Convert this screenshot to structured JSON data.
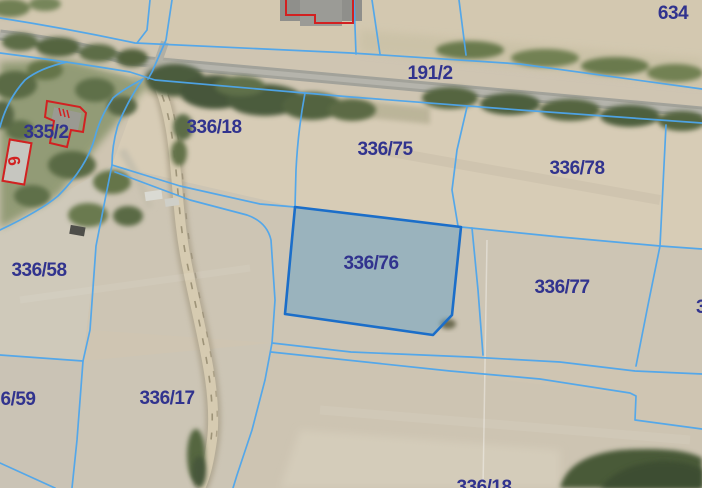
{
  "map": {
    "type": "cadastral-parcel-map-over-aerial-imagery",
    "highlighted_parcel": "336/76",
    "visible_parcel_labels": [
      "335/2",
      "9",
      "336/18",
      "191/2",
      "634",
      "336/75",
      "336/78",
      "336/58",
      "336/76",
      "336/77",
      "6/59",
      "336/17",
      "336/18",
      "3"
    ]
  },
  "labels": {
    "p335_2": "335/2",
    "house_9": "9",
    "p336_18": "336/18",
    "p191_2": "191/2",
    "p634": "634",
    "p336_75": "336/75",
    "p336_78": "336/78",
    "p336_58": "336/58",
    "p336_76": "336/76",
    "p336_77": "336/77",
    "p336_59_clipped": "6/59",
    "p336_17": "336/17",
    "p336_18_bottom": "336/18",
    "p_right_clipped": "3"
  },
  "colors": {
    "boundary": "#4ea6ec",
    "highlight_stroke": "#1b6ec9",
    "highlight_fill": "rgba(104,162,198,0.5)",
    "label": "#31338e",
    "building": "#d22121"
  }
}
